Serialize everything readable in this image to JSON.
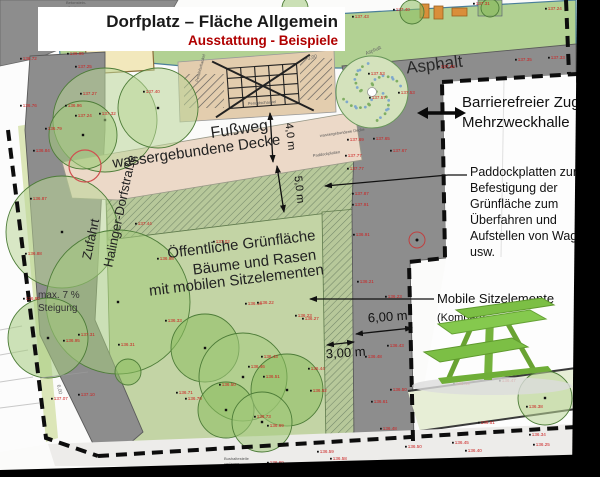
{
  "title": {
    "line1": "Dorfplatz – Fläche Allgemein",
    "line2": "Ausstattung - Beispiele"
  },
  "area_labels": {
    "asphalt_big": "Asphalt",
    "asphalt_small": "Asphalt",
    "fussweg1": "Fußweg",
    "fussweg2": "wassergebundene Decke",
    "wgd_small": "wassergebundene Decke",
    "paddock_small": "Paddockplatten",
    "zufahrt1": "Zufahrt",
    "zufahrt2": "Halinger-Dorfstraße",
    "gruen1": "Öffentliche Grünfläche",
    "gruen2": "Bäume und Rasen",
    "gruen3": "mit mobilen Sitzelementen",
    "steigung1": "max. 7 %",
    "steigung2": "Steigung",
    "sandkasten": "Sandkasten",
    "beton1": "Betonstein-",
    "beton2": "pflaster",
    "pendel": "Pendelschaukel",
    "bus1": "Bushaltestelle",
    "bus2": "verlegen"
  },
  "callouts": {
    "barrier": {
      "line1": "Barrierefreier Zugang",
      "line2": "Mehrzweckhalle"
    },
    "paddock": {
      "lines": [
        "Paddockplatten zur",
        "Befestigung der",
        "Grünfläche zum",
        "Überfahren und",
        "Aufstellen von Wagen",
        "usw."
      ]
    },
    "mobile": {
      "line1": "Mobile Sitzelemente",
      "line2": "(Kompan)"
    }
  },
  "dimensions": {
    "path_width": "4,0 m",
    "green_depth": "5,0 m",
    "strip_width": "6,00 m",
    "paddock_width": "3,00 m",
    "tiny_dim": "3,00",
    "road_dim": "6,00"
  },
  "map": {
    "colors": {
      "asphalt": "#8d8d8d",
      "lawn": "#c3d4a5",
      "hatch_base": "#b7c89a",
      "hatch_line": "#74886a",
      "path_pink": "#ecd9c8",
      "play_band": "#b2d193",
      "play_strip_tan": "#e3cdae",
      "sand": "#f2e8bc",
      "pale_green_strip": "#e7eed6",
      "pale_road": "#edecea",
      "elevation_red": "#cc2222",
      "boundary_black": "#0d0d0d",
      "kompan_green": "#7cbf45",
      "tree_tones": [
        "#b9d697",
        "#a4cb7d",
        "#8cbd60"
      ]
    },
    "trees": [
      [
        105,
        120,
        52,
        0
      ],
      [
        158,
        108,
        40,
        0
      ],
      [
        83,
        135,
        34,
        1
      ],
      [
        62,
        232,
        56,
        0
      ],
      [
        118,
        302,
        72,
        1
      ],
      [
        48,
        338,
        40,
        1
      ],
      [
        205,
        348,
        34,
        2
      ],
      [
        243,
        377,
        44,
        1
      ],
      [
        287,
        390,
        36,
        2
      ],
      [
        226,
        410,
        28,
        2
      ],
      [
        262,
        422,
        30,
        1
      ],
      [
        128,
        372,
        13,
        2
      ],
      [
        545,
        398,
        27,
        0
      ],
      [
        295,
        8,
        13,
        1
      ],
      [
        412,
        12,
        12,
        2
      ],
      [
        490,
        8,
        9,
        2
      ]
    ],
    "dotted_tree": {
      "cx": 372,
      "cy": 92,
      "r": 36
    },
    "elevation_points": [
      [
        25,
        60,
        "136.72"
      ],
      [
        25,
        107,
        "136.76"
      ],
      [
        72,
        55,
        "136.95"
      ],
      [
        80,
        68,
        "137.25"
      ],
      [
        85,
        95,
        "137.27"
      ],
      [
        148,
        93,
        "137.40"
      ],
      [
        70,
        107,
        "136.96"
      ],
      [
        80,
        117,
        "137.24"
      ],
      [
        104,
        115,
        "137.32"
      ],
      [
        50,
        130,
        "136.79"
      ],
      [
        357,
        18,
        "137.43"
      ],
      [
        398,
        11,
        "137.40"
      ],
      [
        478,
        5,
        "137.31"
      ],
      [
        550,
        10,
        "137.24"
      ],
      [
        373,
        75,
        "137.53"
      ],
      [
        443,
        68,
        "137.42"
      ],
      [
        520,
        61,
        "137.35"
      ],
      [
        553,
        59,
        "137.33"
      ],
      [
        403,
        94,
        "137.53"
      ],
      [
        374,
        99,
        "137.57"
      ],
      [
        352,
        141,
        "137.69"
      ],
      [
        378,
        140,
        "137.65"
      ],
      [
        350,
        157,
        "137.77"
      ],
      [
        352,
        170,
        "137.77"
      ],
      [
        395,
        152,
        "137.67"
      ],
      [
        357,
        195,
        "137.87"
      ],
      [
        357,
        206,
        "137.91"
      ],
      [
        358,
        236,
        "136.91"
      ],
      [
        38,
        152,
        "136.84"
      ],
      [
        35,
        200,
        "136.87"
      ],
      [
        30,
        255,
        "136.88"
      ],
      [
        28,
        300,
        "136.90"
      ],
      [
        68,
        342,
        "136.95"
      ],
      [
        83,
        336,
        "137.31"
      ],
      [
        123,
        346,
        "136.31"
      ],
      [
        56,
        400,
        "137.07"
      ],
      [
        83,
        396,
        "137.10"
      ],
      [
        140,
        225,
        "137.44"
      ],
      [
        218,
        243,
        "137.02"
      ],
      [
        162,
        260,
        "136.98"
      ],
      [
        250,
        305,
        "136.16"
      ],
      [
        262,
        304,
        "136.22"
      ],
      [
        300,
        317,
        "136.23"
      ],
      [
        170,
        322,
        "136.33"
      ],
      [
        307,
        320,
        "136.27"
      ],
      [
        362,
        283,
        "136.21"
      ],
      [
        390,
        298,
        "136.23"
      ],
      [
        392,
        347,
        "136.43"
      ],
      [
        370,
        358,
        "136.48"
      ],
      [
        266,
        358,
        "136.43"
      ],
      [
        253,
        368,
        "136.46"
      ],
      [
        268,
        378,
        "136.51"
      ],
      [
        224,
        386,
        "136.50"
      ],
      [
        313,
        370,
        "136.44"
      ],
      [
        181,
        394,
        "136.71"
      ],
      [
        190,
        400,
        "136.70"
      ],
      [
        315,
        392,
        "136.52"
      ],
      [
        259,
        418,
        "136.73"
      ],
      [
        272,
        427,
        "136.69"
      ],
      [
        395,
        391,
        "136.50"
      ],
      [
        376,
        403,
        "136.61"
      ],
      [
        385,
        430,
        "136.48"
      ],
      [
        458,
        385,
        "136.49"
      ],
      [
        504,
        382,
        "136.47"
      ],
      [
        531,
        408,
        "136.38"
      ],
      [
        483,
        424,
        "136.51"
      ],
      [
        534,
        436,
        "136.34"
      ],
      [
        457,
        444,
        "136.45"
      ],
      [
        538,
        446,
        "136.25"
      ],
      [
        470,
        452,
        "136.40"
      ],
      [
        322,
        453,
        "136.59"
      ],
      [
        335,
        460,
        "136.58"
      ],
      [
        272,
        464,
        "136.69"
      ],
      [
        410,
        448,
        "136.50"
      ]
    ]
  }
}
